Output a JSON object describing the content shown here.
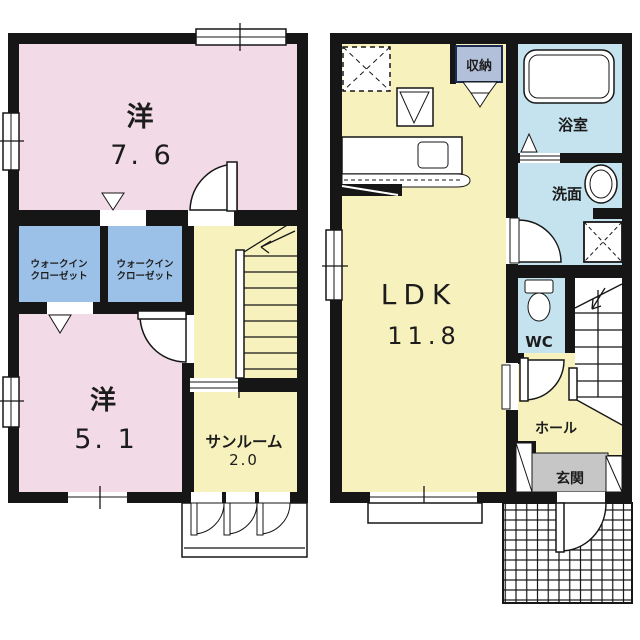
{
  "floor_plan": {
    "second_floor": {
      "bedroom_large": {
        "name": "洋",
        "size": "7.  6"
      },
      "wic_left": {
        "line1": "ウォークイン",
        "line2": "クローゼット"
      },
      "wic_right": {
        "line1": "ウォークイン",
        "line2": "クローゼット"
      },
      "bedroom_small": {
        "name": "洋",
        "size": "5.  1"
      },
      "sunroom": {
        "name": "サンルーム",
        "size": "2.0"
      }
    },
    "first_floor": {
      "ldk": {
        "name": "LDK",
        "size": "11.8"
      },
      "storage": {
        "name": "収納"
      },
      "bathroom": {
        "name": "浴室"
      },
      "washroom": {
        "name": "洗面"
      },
      "wc": {
        "name": "WC"
      },
      "hall": {
        "name": "ホール"
      },
      "entrance": {
        "name": "玄関"
      }
    },
    "colors": {
      "wall": "#161616",
      "bedroom_pink": "#f2dae6",
      "closet_blue": "#9cc1e8",
      "living_yellow": "#f6f1bd",
      "wet_area_blue": "#c5e3ee",
      "entrance_gray": "#c6c6c6",
      "storage_label_blue": "#b3c0d9"
    }
  }
}
